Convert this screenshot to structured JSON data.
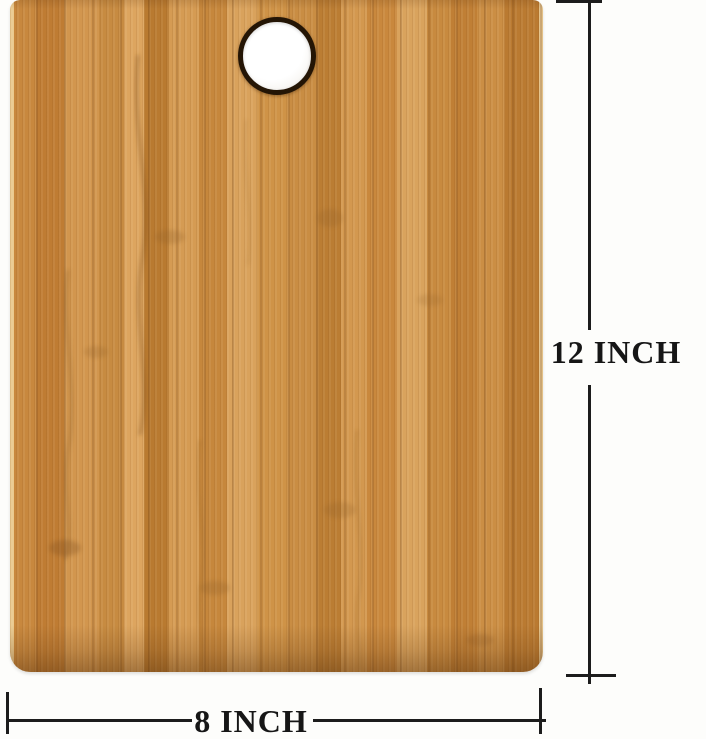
{
  "image": {
    "background_color": "#fdfdfb"
  },
  "product": {
    "name": "bamboo-cutting-board",
    "wood_colors": [
      "#c8883e",
      "#d2964e",
      "#dda55f",
      "#bf7c33",
      "#b97a30",
      "#cf9347",
      "#e3c189"
    ],
    "hole_ring_color": "#241505",
    "hole_fill_color": "#ffffff"
  },
  "annotations": {
    "height_label": "12 INCH",
    "width_label": "8 INCH",
    "line_color": "#1c1c1c",
    "text_color": "#161616"
  }
}
